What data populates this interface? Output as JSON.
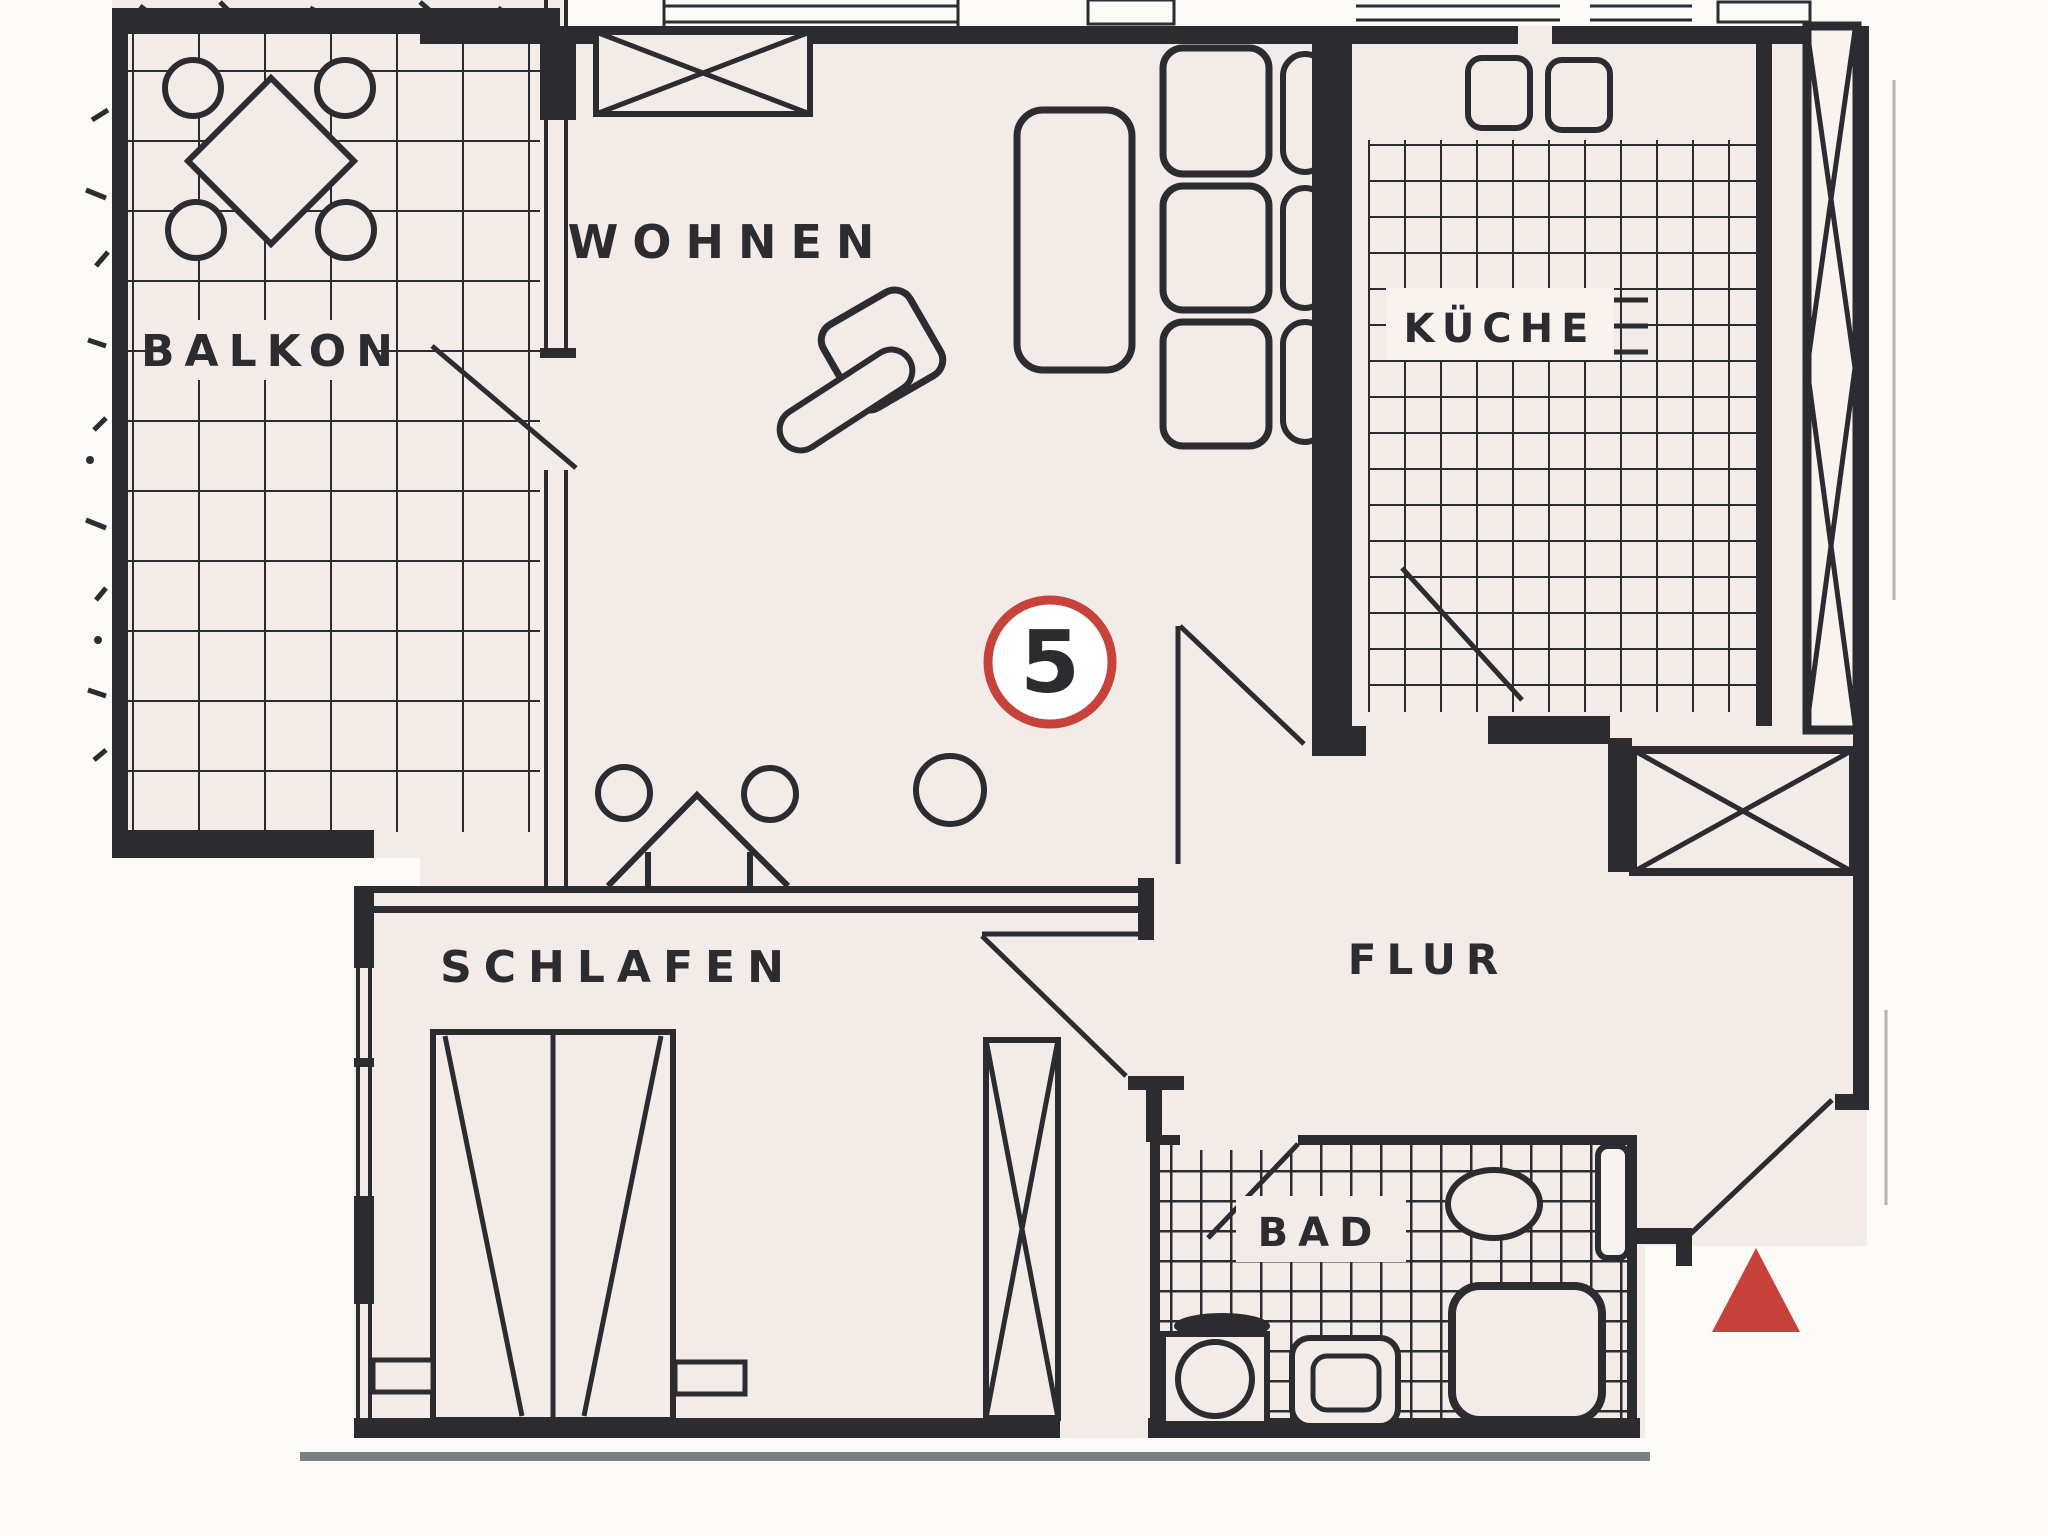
{
  "meta": {
    "type": "apartment-floor-plan",
    "language": "de"
  },
  "colors": {
    "paper": "#f3ebe7",
    "ink": "#2b2b30",
    "accent_red": "#c8423c",
    "plate": "#f8f3ef",
    "page": "#fbfaf7",
    "baseline_gray": "#5f6b70",
    "faint": "#b9b2ae"
  },
  "unit_badge": {
    "number": "5"
  },
  "entrance_marker": {
    "icon": "entrance-triangle-icon",
    "color": "#c8423c"
  },
  "rooms": [
    {
      "id": "balkon",
      "label": "BALKON"
    },
    {
      "id": "wohnen",
      "label": "WOHNEN"
    },
    {
      "id": "kueche",
      "label": "KÜCHE"
    },
    {
      "id": "schlafen",
      "label": "SCHLAFEN"
    },
    {
      "id": "flur",
      "label": "FLUR"
    },
    {
      "id": "bad",
      "label": "BAD"
    }
  ]
}
